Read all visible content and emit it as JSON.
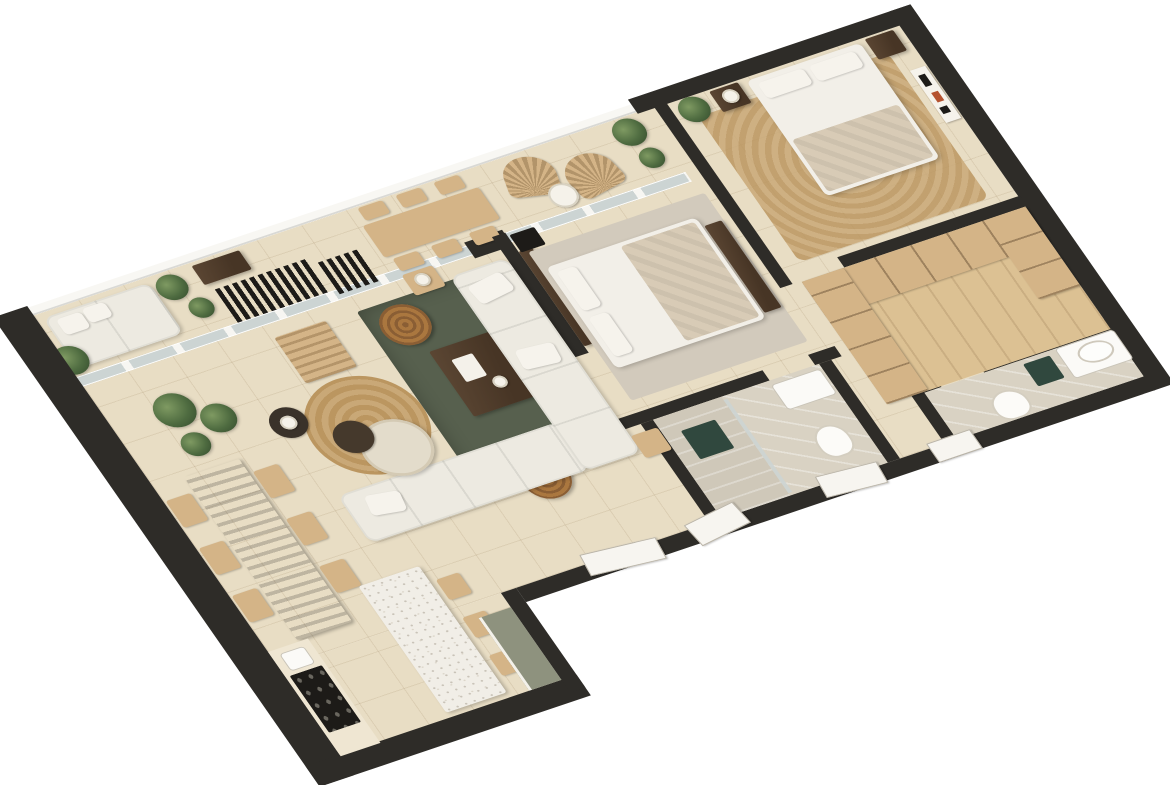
{
  "scene": {
    "type": "3d-isometric-floor-plan-render",
    "description": "Top-down 3D rendering of a two-bedroom apartment, rotated diagonally on a white background. Charcoal cut walls, beige stone tile floors, wrap-around balcony along the upper edge.",
    "rooms": [
      {
        "name": "balcony-terrace",
        "furniture": [
          "white daybed with cushions",
          "potted plants",
          "dark console table",
          "black slatted bench",
          "black folding chair",
          "light oak outdoor dining table",
          "six outdoor chairs",
          "two fan-back rattan lounge chairs",
          "round white side table"
        ]
      },
      {
        "name": "living-room",
        "furniture": [
          "white L-shaped sectional sofa",
          "dark olive green area rug",
          "walnut coffee table with white tray",
          "two round rattan poufs",
          "round jute rug",
          "travertine round table",
          "small black round table",
          "oak lounge chair",
          "oak side table with lamp",
          "small oak stool"
        ]
      },
      {
        "name": "dining-area",
        "furniture": [
          "dark walnut dining table",
          "six light oak chairs",
          "corner potted plants"
        ]
      },
      {
        "name": "kitchen",
        "furniture": [
          "white terrazzo island",
          "three oak bar stools",
          "counter with black cooktop",
          "small appliance",
          "sage green cabinet run"
        ]
      },
      {
        "name": "bedroom-2",
        "furniture": [
          "double bed with white duvet and beige throw",
          "dark wood headboard wall",
          "light gray rug",
          "dark nightstand",
          "foot-of-bed shelf"
        ]
      },
      {
        "name": "master-bedroom",
        "furniture": [
          "double bed with white duvet and beige throw",
          "jute rug",
          "two dark nightstands",
          "table lamp",
          "abstract wall art",
          "potted plant"
        ]
      },
      {
        "name": "walk-in-closet",
        "furniture": [
          "U-shaped light oak wardrobe shelving"
        ]
      },
      {
        "name": "master-bathroom",
        "furniture": [
          "white counter with oval vessel sink",
          "toilet",
          "dark teal accent tile"
        ]
      },
      {
        "name": "bathroom-2",
        "furniture": [
          "walk-in shower with glass panel",
          "dark teal accent tile",
          "white vanity",
          "toilet"
        ]
      },
      {
        "name": "hallway",
        "furniture": [
          "open white door panels"
        ]
      }
    ]
  },
  "palette": {
    "wall_dark": "#2e2c28",
    "wall_cream": "#efe6d2",
    "floor_tile": "#e8ddc4",
    "railing_white": "#f8f7f3",
    "glass": "#ccd4d3",
    "sofa_white": "#edeae1",
    "rug_green": "#57604e",
    "rug_gray": "#d2cabc",
    "jute_light": "#c9a877",
    "jute_dark": "#bb9660",
    "wood_oak": "#d4b487",
    "wood_walnut": "#5b4633",
    "wood_floor": "#dcc193",
    "black_furniture": "#1d1b18",
    "terrazzo": "#f1eee7",
    "marble": "#d9d2c3",
    "plant_light": "#7f9a62",
    "plant_green": "#4e6b40",
    "plant_dark": "#32482b",
    "pot_tan": "#b98f63",
    "rattan_light": "#aa773f",
    "rattan_dark": "#8a5e34",
    "bed_white": "#f2efe8",
    "bed_beige": "#d8cbb6",
    "accent_teal": "#30483e",
    "sage": "#8e927e",
    "art_red": "#b5522f"
  }
}
